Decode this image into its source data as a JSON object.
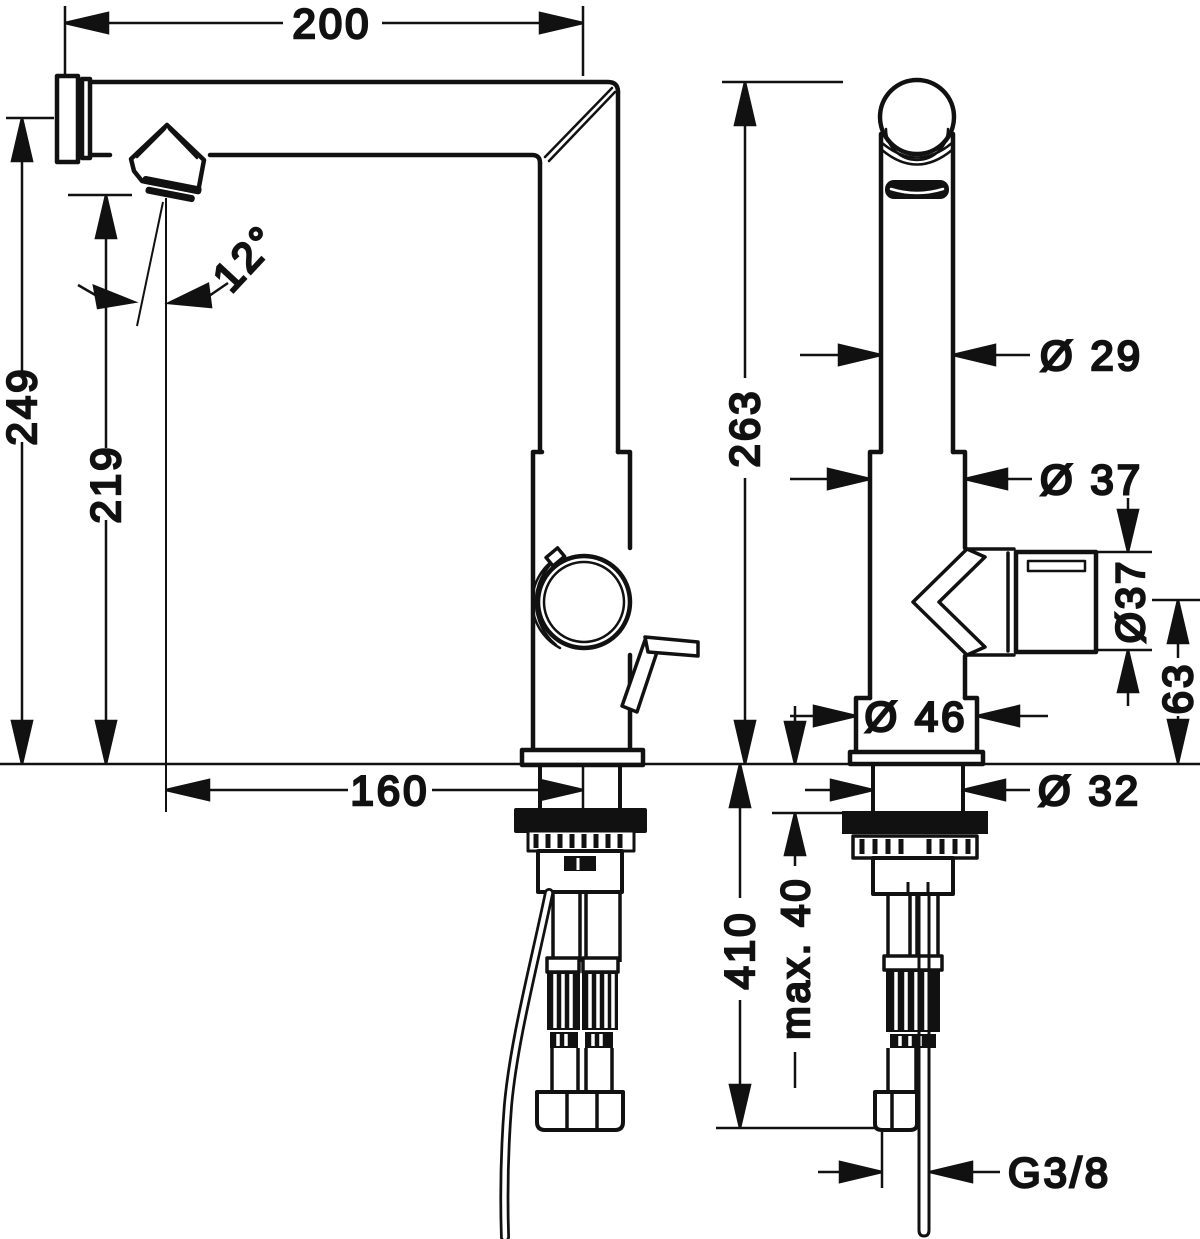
{
  "colors": {
    "ink": "#111111",
    "paper": "#ffffff"
  },
  "dimensions": {
    "spout_reach": {
      "label": "200"
    },
    "spout_height": {
      "label": "249"
    },
    "aerator_height": {
      "label": "219"
    },
    "spray_angle": {
      "label": "12°"
    },
    "aerator_offset": {
      "label": "160"
    },
    "total_height": {
      "label": "263"
    },
    "spout_dia": {
      "label": "Ø 29"
    },
    "body_dia": {
      "label": "Ø 37"
    },
    "handle_dia": {
      "label": "Ø37"
    },
    "handle_height": {
      "label": "63"
    },
    "base_dia": {
      "label": "Ø 46"
    },
    "shank_dia": {
      "label": "Ø 32"
    },
    "hose_length": {
      "label": "410"
    },
    "max_counter_thickness": {
      "label": "max. 40"
    },
    "thread": {
      "label": "G3/8"
    }
  }
}
